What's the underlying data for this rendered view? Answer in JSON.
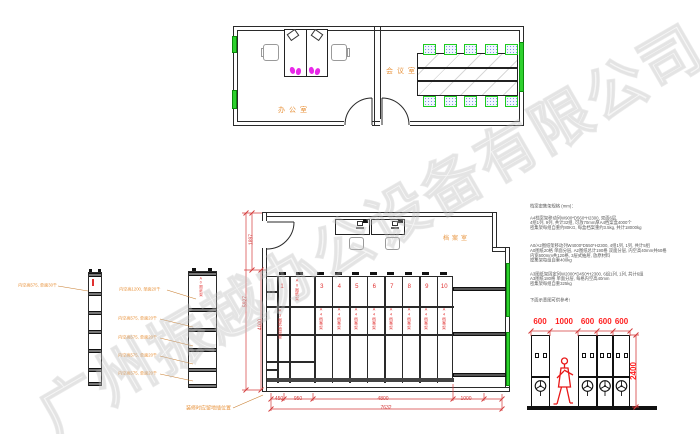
{
  "watermark": "广州振越办公设备有限公司",
  "rooms": {
    "office": "办公室",
    "meeting": "会议室",
    "archive": "档案室"
  },
  "archive_units": [
    {
      "num": "1",
      "label": "A3图纸抽屉架"
    },
    {
      "num": "",
      "label": "A0图纸架"
    },
    {
      "num": "3",
      "label": "A4档案架"
    },
    {
      "num": "4",
      "label": "A4档案架"
    },
    {
      "num": "5",
      "label": "A4档案架"
    },
    {
      "num": "6",
      "label": "A4档案架"
    },
    {
      "num": "7",
      "label": "A4档案架"
    },
    {
      "num": "8",
      "label": "A4档案架"
    },
    {
      "num": "9",
      "label": "A4档案架"
    },
    {
      "num": "10",
      "label": "A4档案架"
    }
  ],
  "dims": {
    "plan_bottom": [
      "450",
      "950",
      "4800",
      "1000"
    ],
    "plan_total": "7632",
    "plan_left": [
      "1897",
      "5927",
      "4000"
    ],
    "side_top": [
      "600",
      "1000",
      "600",
      "600",
      "600"
    ],
    "side_height": "2400"
  },
  "shelf_labels": {
    "a": "内空高575, 单面30千",
    "b1": "内空高1200, 单面20千",
    "b2": "内空高575, 单面20千",
    "b3": "内空高575, 单面20千",
    "b4": "内空高575, 单面20千",
    "b5": "内空高575, 单面20千",
    "shelf_b_mark": "A0图纸架",
    "floor_note": "装修时应留地插位置"
  },
  "specs": {
    "title": "档案密集架规格 (mm)：",
    "p1": [
      "A4档案架移动列W900*D560*H2300, 双面6层,",
      "4组1列, 9列, 共计32组, 可放70mm厚A4档案盒4000个",
      "密集架每组自重约80KG, 每盒档案重约3.5kg, 共计18000kg"
    ],
    "p2": [
      "A0/A2图纸架移动列W4000*D550*H2300, 4组1列, 1列, 共计5组",
      "A0图纸20格 单面分层, A2图纸总计190格 双面分层, 内空高40mm共60格",
      "内宽600mm共120格, 3层式抽屉, 放原材料",
      "密集架每组自重400kg"
    ],
    "p3": [
      "A3图纸架固定列W2000*D450*H2300, 6组1列, 1列, 共计6组",
      "A3图纸180格 单面分层, 每格内空高40mm",
      "密集架每组自重325kg"
    ],
    "note": "下面示意图可供参考!"
  },
  "colors": {
    "wall": "#2a2a2a",
    "dim_red": "#d43c3c",
    "bright_red": "#ff2020",
    "orange": "#e8933c",
    "unit_red": "#e03030",
    "window_green": "#2ed12e",
    "magenta": "#e829e8"
  }
}
